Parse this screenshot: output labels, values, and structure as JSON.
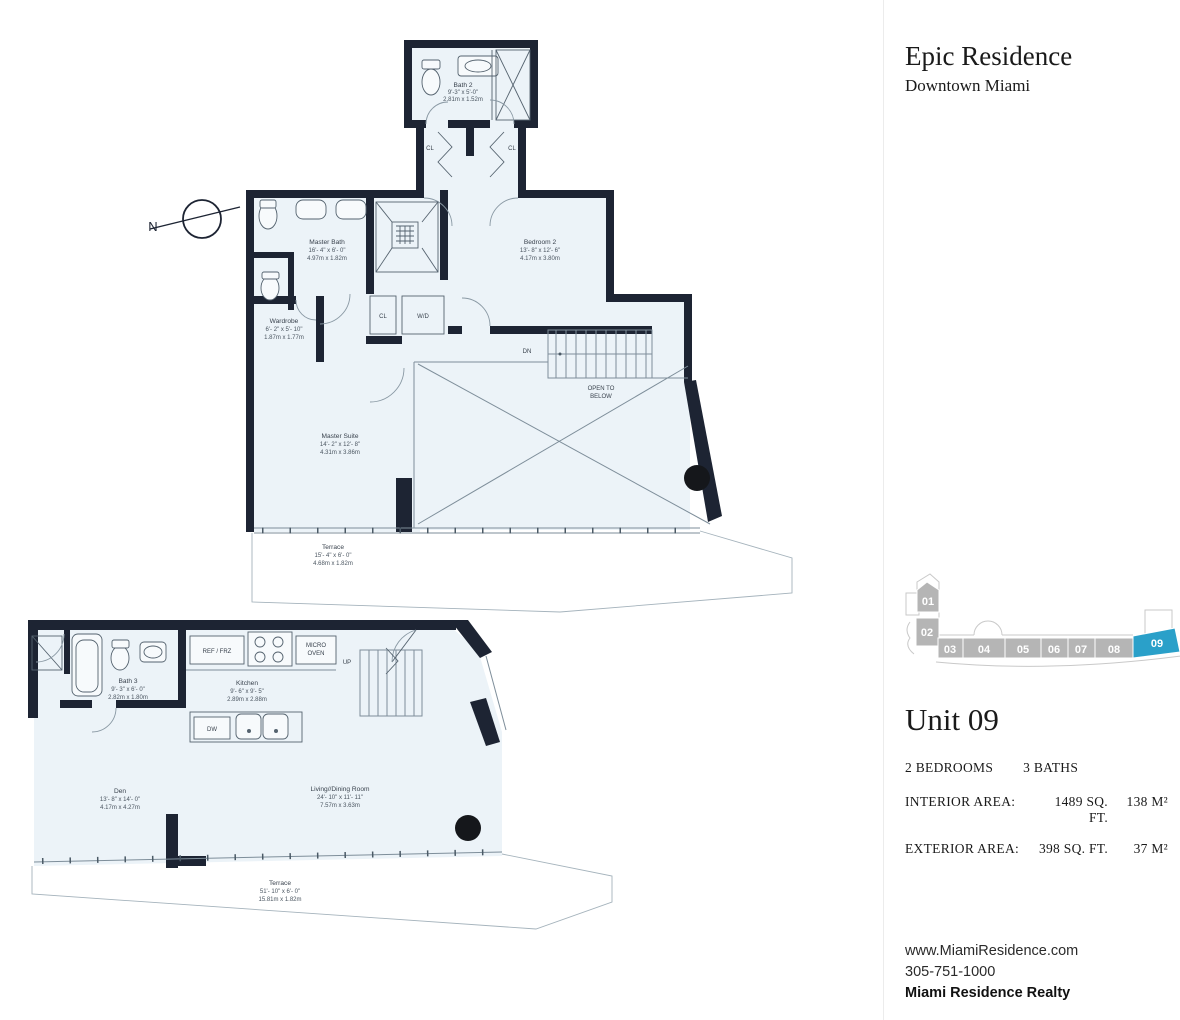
{
  "header": {
    "title": "Epic Residence",
    "subtitle": "Downtown Miami"
  },
  "compass": {
    "label": "N"
  },
  "upper_plan": {
    "rooms": [
      {
        "name": "Bath 2",
        "imperial": "9'-3\" x 5'-0\"",
        "metric": "2.81m x 1.52m"
      },
      {
        "name": "Master Bath",
        "imperial": "16'- 4\" x 6'- 0\"",
        "metric": "4.97m x 1.82m"
      },
      {
        "name": "Bedroom 2",
        "imperial": "13'- 8\" x 12'- 6\"",
        "metric": "4.17m x 3.80m"
      },
      {
        "name": "Wardrobe",
        "imperial": "6'- 2\" x 5'- 10\"",
        "metric": "1.87m x 1.77m"
      },
      {
        "name": "Master Suite",
        "imperial": "14'- 2\" x 12'- 8\"",
        "metric": "4.31m x 3.86m"
      },
      {
        "name": "Terrace",
        "imperial": "15'- 4\" x 6'- 0\"",
        "metric": "4.68m x 1.82m"
      }
    ],
    "annotations": {
      "cl": "CL",
      "wd": "W/D",
      "dn": "DN",
      "open_to": "OPEN TO",
      "below": "BELOW"
    }
  },
  "lower_plan": {
    "rooms": [
      {
        "name": "Bath 3",
        "imperial": "9'- 3\" x 6'- 0\"",
        "metric": "2.82m x 1.80m"
      },
      {
        "name": "Kitchen",
        "imperial": "9'- 6\" x 9'- 5\"",
        "metric": "2.89m x 2.88m"
      },
      {
        "name": "Den",
        "imperial": "13'- 8\" x 14'- 0\"",
        "metric": "4.17m x 4.27m"
      },
      {
        "name": "Living//Dining Room",
        "imperial": "24'- 10\" x 11'- 11\"",
        "metric": "7.57m x 3.63m"
      },
      {
        "name": "Terrace",
        "imperial": "51'- 10\" x 6'- 0\"",
        "metric": "15.81m x 1.82m"
      }
    ],
    "annotations": {
      "ref_frz": "REF / FRZ",
      "micro_line1": "MICRO",
      "micro_line2": "OVEN",
      "dw": "DW",
      "up": "UP"
    }
  },
  "key_plan": {
    "units": [
      "01",
      "02",
      "03",
      "04",
      "05",
      "06",
      "07",
      "08",
      "09"
    ],
    "highlighted_unit": "09",
    "highlight_color": "#2AA0C9",
    "unit_color": "#B5B5B5"
  },
  "unit_info": {
    "title": "Unit 09",
    "bedrooms": "2 BEDROOMS",
    "baths": "3 BATHS",
    "interior_label": "INTERIOR AREA:",
    "interior_imperial": "1489 SQ. FT.",
    "interior_metric": "138 M²",
    "exterior_label": "EXTERIOR AREA:",
    "exterior_imperial": "398 SQ. FT.",
    "exterior_metric": "37 M²"
  },
  "footer": {
    "website": "www.MiamiResidence.com",
    "phone": "305-751-1000",
    "company": "Miami Residence Realty"
  }
}
